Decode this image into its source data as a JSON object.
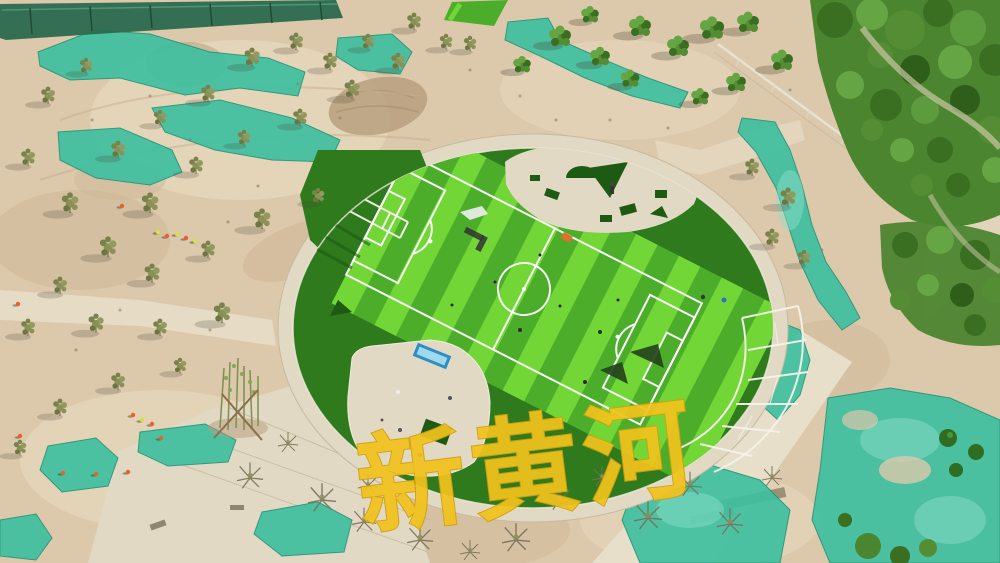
{
  "meta": {
    "domain": "Natural-Image",
    "description": "Aerial drone photo of a park under construction: a circular plaza holding a striped artificial-turf soccer field, surrounded by sandy graded ground, teal dust-control netting, newly planted trees, concrete walkways and construction workers",
    "size": {
      "width": 1000,
      "height": 563
    }
  },
  "watermark": {
    "text": "新黄河",
    "color": "#f2c31c"
  },
  "scene": {
    "field": {
      "name": "soccer-field",
      "bright_stripe_count": 9,
      "markings": [
        "boundary",
        "center-line",
        "center-circle",
        "penalty-areas",
        "penalty-arcs",
        "goal-areas"
      ]
    },
    "features": [
      {
        "name": "circular-plaza"
      },
      {
        "name": "concrete-walkways"
      },
      {
        "name": "dust-control-nets"
      },
      {
        "name": "planted-trees"
      },
      {
        "name": "construction-workers"
      },
      {
        "name": "white-frame-structures"
      },
      {
        "name": "blue-bench"
      },
      {
        "name": "turf-offcut-pieces"
      },
      {
        "name": "site-fence"
      }
    ]
  },
  "palette": {
    "sand": "#dcc8ab",
    "sand_light": "#ecdfc6",
    "sand_dark": "#c6ae8e",
    "dirt": "#b59c7c",
    "concrete": "#e2d9c5",
    "path": "#e8dfca",
    "concrete_line": "#bfb399",
    "net_teal": "#3fc0a0",
    "net_teal_deep": "#259478",
    "net_teal_light": "#8fe0cb",
    "turf_bright": "#72d636",
    "turf_mid": "#4cad2b",
    "turf_dark": "#2e7a1d",
    "turf_deep": "#1d5a12",
    "tree_green": "#558d34",
    "tree_green_dark": "#3a6e21",
    "tree_olive": "#8a9157",
    "marking_white": "#ffffff",
    "watermark_yellow": "#f2c31c",
    "vest_orange": "#e8622d",
    "vest_yellow": "#d8e23c",
    "bench_blue": "#2f8fc4",
    "bench_blue_light": "#9fd9ee",
    "fence_dark": "#2b6a4e"
  }
}
